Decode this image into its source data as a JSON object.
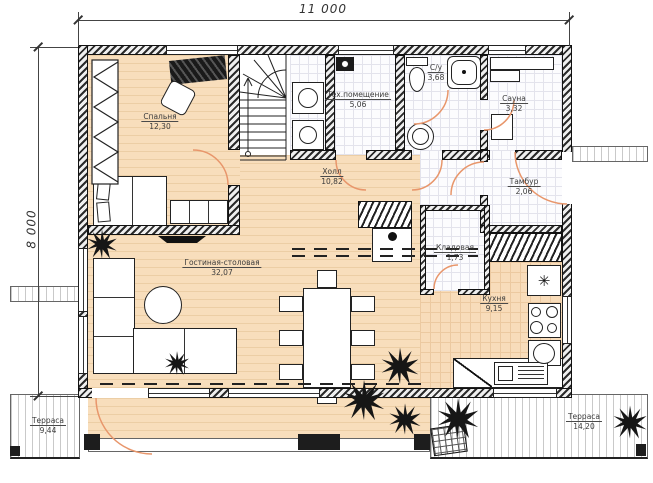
{
  "title": "План 1-го этажа",
  "dimensions": {
    "width": "11 000",
    "height": "8 000"
  },
  "rooms": [
    {
      "name": "Спальня",
      "area": "12,30"
    },
    {
      "name": "Тех.помещение",
      "area": "5,06"
    },
    {
      "name": "С/у",
      "area": "3,68"
    },
    {
      "name": "Сауна",
      "area": "3,32"
    },
    {
      "name": "Холл",
      "area": "10,82"
    },
    {
      "name": "Тамбур",
      "area": "2,06"
    },
    {
      "name": "Кладовая",
      "area": "1,73"
    },
    {
      "name": "Гостиная-столовая",
      "area": "32,07"
    },
    {
      "name": "Кухня",
      "area": "9,15"
    },
    {
      "name": "Терраса",
      "area": "9,44"
    },
    {
      "name": "Терраса",
      "area": "14,20"
    }
  ],
  "icons": {
    "fridge": "✳"
  },
  "colors": {
    "door_arc": "#e8966b",
    "wall": "#1c1c1c",
    "wood": "#f8debc",
    "label": "#3b3b3b"
  }
}
